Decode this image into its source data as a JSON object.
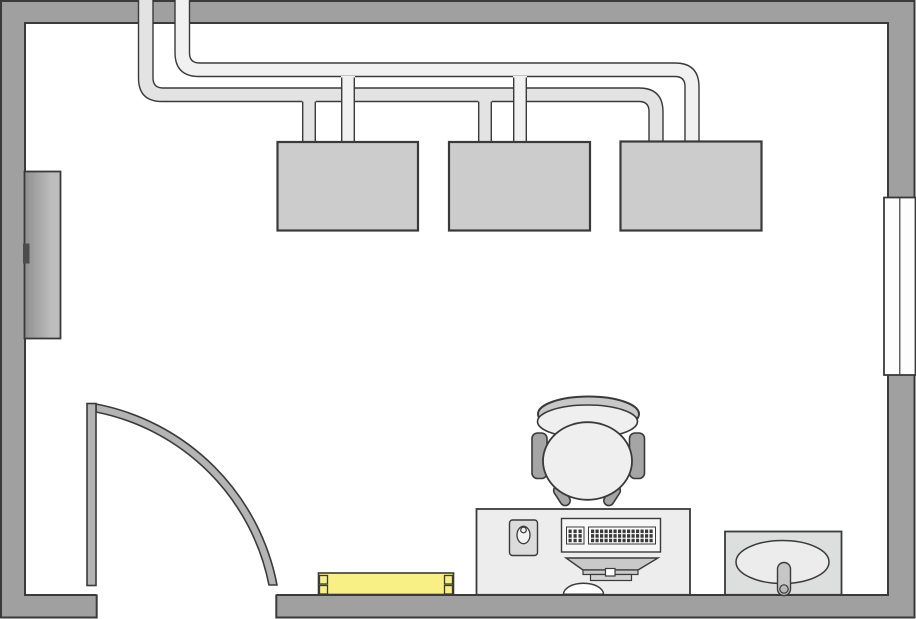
{
  "canvas": {
    "width": 916,
    "height": 619
  },
  "colors": {
    "background": "#ffffff",
    "outline": "#3a3a3a",
    "wall": "#a0a0a0",
    "window_fill": "#fdfdfd",
    "cabinet_dark": "#8f8f8f",
    "cabinet_light": "#bdbdbd",
    "cabinet_handle": "#4c4c4c",
    "duct_supply": "#f1f1f1",
    "duct_return": "#e3e3e3",
    "unit_fill": "#cbcccb",
    "door_fill": "#b4b4b4",
    "heater_fill": "#f8ef85",
    "desk_fill": "#ededed",
    "mousepad_fill": "#dcdcdc",
    "mouse_fill": "#f2f2f2",
    "keyboard_fill": "#f7f7f7",
    "keyblock_fill": "#ffffff",
    "keys_dark": "#3a3a3a",
    "monitor_fill": "#c9c9c9",
    "monitor_base_fill": "#d2d2d2",
    "notch_fill": "#ffffff",
    "grommet_fill": "#ffffff",
    "chair_back_fill": "#c8c8c8",
    "chair_seat_fill": "#efefef",
    "chair_arm_fill": "#a5a5a5",
    "sink_counter_fill": "#dcdfdd",
    "sink_basin_fill": "#ececec",
    "faucet_fill": "#c6c6c6",
    "faucet_knob_fill": "#b9b9b9"
  },
  "objects": {
    "walls": "walls",
    "door_opening": "door-opening",
    "window": "window",
    "cabinet": "wall-cabinet",
    "duct_return": "duct-run-lower",
    "duct_supply": "duct-run-upper",
    "units": [
      "hvac-unit-1",
      "hvac-unit-2",
      "hvac-unit-3"
    ],
    "door": "swing-door",
    "heater": "baseboard-heater",
    "desk": "computer-desk",
    "mousepad": "mouse-pad",
    "mouse": "mouse",
    "keyboard": "keyboard",
    "monitor": "monitor",
    "grommet": "cable-grommet",
    "chair": "office-chair",
    "sink": "sink-unit"
  }
}
